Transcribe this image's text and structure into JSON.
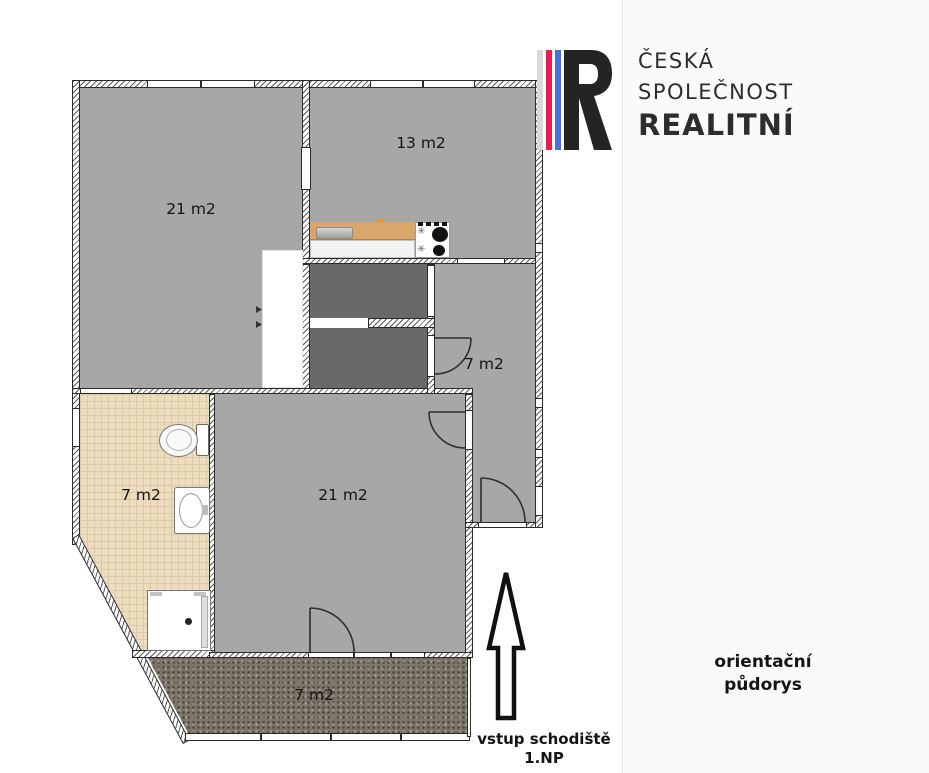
{
  "brand": {
    "name_lines": [
      "ČESKÁ",
      "SPOLEČNOST",
      "REALITNÍ"
    ],
    "logo_letter": "R",
    "stripe_colors": {
      "gray": "#d9d9d9",
      "red": "#ed1a4f",
      "blue": "#4c6fdc"
    }
  },
  "caption": {
    "line1": "orientační",
    "line2": "půdorys"
  },
  "entrance": {
    "line1": "vstup schodiště",
    "line2": "1.NP"
  },
  "rooms": [
    {
      "id": "room-upper-left",
      "label": "21 m2"
    },
    {
      "id": "kitchen",
      "label": "13 m2"
    },
    {
      "id": "hallway",
      "label": "7 m2"
    },
    {
      "id": "bathroom",
      "label": "7 m2"
    },
    {
      "id": "living-room",
      "label": "21 m2"
    },
    {
      "id": "terrace",
      "label": "7 m2"
    }
  ],
  "icons": {
    "entrance_arrow": "up-arrow-outline",
    "fixtures": [
      "toilet",
      "washbasin",
      "shower",
      "kitchen-counter",
      "kitchen-sink",
      "stove"
    ]
  },
  "palette": {
    "room_fill": "#a7a7a7",
    "closet_fill": "#696969",
    "bathroom_tile": "#eedcc1",
    "terrace_fill": "#7d7568",
    "counter_wood": "#d9a76b",
    "wall_line": "#2b2b2b"
  }
}
